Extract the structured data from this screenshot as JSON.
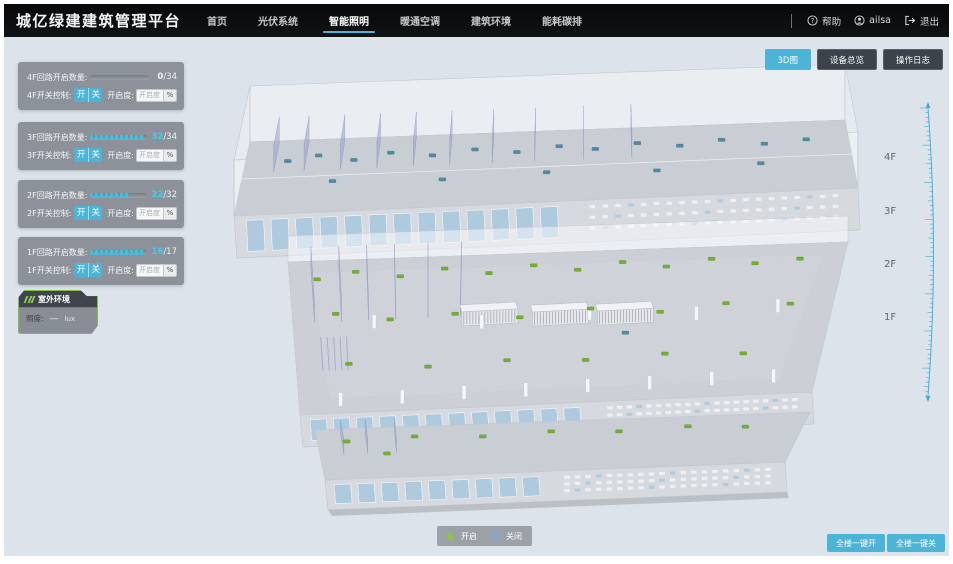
{
  "app": {
    "title": "城亿绿建建筑管理平台"
  },
  "nav": {
    "items": [
      {
        "label": "首页"
      },
      {
        "label": "光伏系统"
      },
      {
        "label": "智能照明"
      },
      {
        "label": "暖通空调"
      },
      {
        "label": "建筑环境"
      },
      {
        "label": "能耗碳排"
      }
    ],
    "active_index": 2
  },
  "user_bar": {
    "help": "帮助",
    "username": "ailsa",
    "logout": "退出"
  },
  "view_buttons": [
    {
      "label": "3D图",
      "active": true
    },
    {
      "label": "设备总览",
      "active": false
    },
    {
      "label": "操作日志",
      "active": false
    }
  ],
  "floor_panels": {
    "count_label_suffix": "回路开启数量:",
    "switch_label_suffix": "开关控制:",
    "on_label": "开",
    "off_label": "关",
    "openness_label": "开启度:",
    "openness_placeholder": "开启度",
    "percent_label": "%",
    "floors": [
      {
        "id": "4F",
        "current": "0",
        "total": "/34",
        "progress": 0,
        "highlight": false
      },
      {
        "id": "3F",
        "current": "32",
        "total": "/34",
        "progress": 94,
        "highlight": true
      },
      {
        "id": "2F",
        "current": "22",
        "total": "/32",
        "progress": 69,
        "highlight": true
      },
      {
        "id": "1F",
        "current": "16",
        "total": "/17",
        "progress": 94,
        "highlight": true
      }
    ]
  },
  "outdoor_panel": {
    "title": "室外环境",
    "metric_label": "照度:",
    "value": "—",
    "unit": "lux"
  },
  "floor_scale": {
    "labels": [
      "4F",
      "3F",
      "2F",
      "1F"
    ]
  },
  "legend": {
    "on": "开启",
    "off": "关闭"
  },
  "bulk_buttons": [
    {
      "label": "全楼一键开"
    },
    {
      "label": "全楼一键关"
    }
  ],
  "colors": {
    "accent": "#4cb4d6",
    "value_cyan": "#3fd0f0",
    "on_green": "#6db32c",
    "off_blue": "#4e8ca4",
    "legend_green": "#8bc34a",
    "legend_blue": "#7ea9cc",
    "scene_bg": "#dce3ea"
  }
}
